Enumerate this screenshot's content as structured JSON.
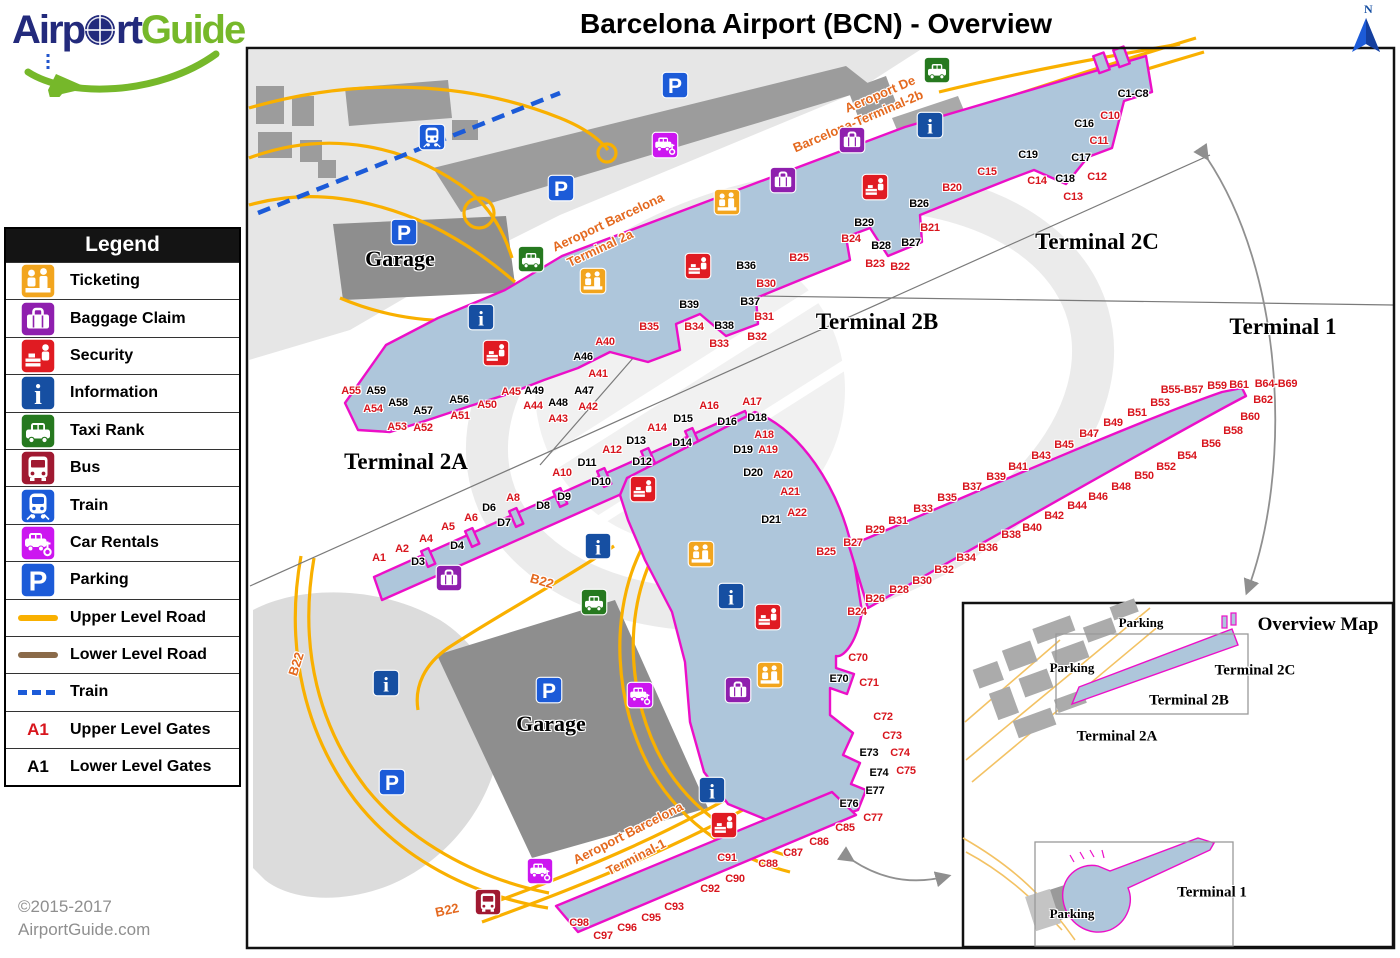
{
  "header": {
    "logo": {
      "airport_part1": "Airp",
      "airport_part2": "rt",
      "guide": "Guide"
    },
    "title": "Barcelona Airport (BCN) - Overview",
    "compass_label": "N"
  },
  "footer": {
    "copyright_line1": "©2015-2017",
    "copyright_line2": "AirportGuide.com"
  },
  "colors": {
    "terminal_fill": "#aec6db",
    "terminal_outline": "#ec0fc8",
    "road_upper": "#f9b000",
    "road_lower": "#8a6a49",
    "train_line": "#1c5bd8",
    "gate_upper": "#d8151d",
    "gate_lower": "#000000",
    "ticketing": "#f2a51e",
    "baggage": "#8f1fae",
    "security": "#e01b22",
    "information": "#164fa2",
    "taxi": "#26791f",
    "bus": "#a01931",
    "train": "#1c5bd8",
    "car_rental": "#cc16f0",
    "parking": "#1c5bd8"
  },
  "legend": {
    "title": "Legend",
    "items": [
      {
        "kind": "icon",
        "icon": "ticketing",
        "label": "Ticketing"
      },
      {
        "kind": "icon",
        "icon": "baggage",
        "label": "Baggage Claim"
      },
      {
        "kind": "icon",
        "icon": "security",
        "label": "Security"
      },
      {
        "kind": "icon",
        "icon": "information",
        "label": "Information"
      },
      {
        "kind": "icon",
        "icon": "taxi",
        "label": "Taxi Rank"
      },
      {
        "kind": "icon",
        "icon": "bus",
        "label": "Bus"
      },
      {
        "kind": "icon",
        "icon": "train",
        "label": "Train"
      },
      {
        "kind": "icon",
        "icon": "car-rental",
        "label": "Car Rentals"
      },
      {
        "kind": "icon",
        "icon": "parking",
        "label": "Parking"
      },
      {
        "kind": "line",
        "line": "upper-road",
        "label": "Upper Level Road"
      },
      {
        "kind": "line",
        "line": "lower-road",
        "label": "Lower Level  Road"
      },
      {
        "kind": "line",
        "line": "train-line",
        "label": "Train"
      },
      {
        "kind": "gate",
        "sample": "A1",
        "level": "upper",
        "label": "Upper Level Gates"
      },
      {
        "kind": "gate",
        "sample": "A1",
        "level": "lower",
        "label": "Lower Level Gates"
      }
    ]
  },
  "map": {
    "terminal_labels": [
      {
        "text": "Terminal 2C",
        "x": 1097,
        "y": 242
      },
      {
        "text": "Terminal 2B",
        "x": 877,
        "y": 322
      },
      {
        "text": "Terminal 1",
        "x": 1283,
        "y": 327
      },
      {
        "text": "Terminal 2A",
        "x": 406,
        "y": 462
      }
    ],
    "garage_labels": [
      {
        "text": "Garage",
        "x": 400,
        "y": 259
      },
      {
        "text": "Garage",
        "x": 551,
        "y": 724
      }
    ],
    "road_labels": [
      {
        "text": "Aeroport De",
        "x": 880,
        "y": 94,
        "rotate": -23
      },
      {
        "text": "Barcelona-Terminal-2b",
        "x": 858,
        "y": 121,
        "rotate": -23
      },
      {
        "text": "Aeroport Barcelona",
        "x": 608,
        "y": 222,
        "rotate": -25
      },
      {
        "text": "Terminal 2a",
        "x": 600,
        "y": 248,
        "rotate": -25
      },
      {
        "text": "Aeroport Barcelona",
        "x": 628,
        "y": 833,
        "rotate": -27
      },
      {
        "text": "Terminal-1",
        "x": 636,
        "y": 857,
        "rotate": -27
      },
      {
        "text": "B22",
        "x": 542,
        "y": 581,
        "rotate": 16
      },
      {
        "text": "B22",
        "x": 296,
        "y": 664,
        "rotate": -72
      },
      {
        "text": "B22",
        "x": 447,
        "y": 910,
        "rotate": -12
      }
    ],
    "gates_upper": [
      {
        "text": "C10",
        "x": 1110,
        "y": 116
      },
      {
        "text": "C11",
        "x": 1099,
        "y": 141
      },
      {
        "text": "C12",
        "x": 1097,
        "y": 177
      },
      {
        "text": "C13",
        "x": 1073,
        "y": 197
      },
      {
        "text": "C14",
        "x": 1037,
        "y": 181
      },
      {
        "text": "C15",
        "x": 987,
        "y": 172
      },
      {
        "text": "B20",
        "x": 952,
        "y": 188
      },
      {
        "text": "B21",
        "x": 930,
        "y": 228
      },
      {
        "text": "B22",
        "x": 900,
        "y": 267
      },
      {
        "text": "B23",
        "x": 875,
        "y": 264
      },
      {
        "text": "B24",
        "x": 851,
        "y": 239
      },
      {
        "text": "B25",
        "x": 799,
        "y": 258
      },
      {
        "text": "B30",
        "x": 766,
        "y": 284
      },
      {
        "text": "B31",
        "x": 764,
        "y": 317
      },
      {
        "text": "B32",
        "x": 757,
        "y": 337
      },
      {
        "text": "B33",
        "x": 719,
        "y": 344
      },
      {
        "text": "B34",
        "x": 694,
        "y": 327
      },
      {
        "text": "B35",
        "x": 649,
        "y": 327
      },
      {
        "text": "A40",
        "x": 605,
        "y": 342
      },
      {
        "text": "A41",
        "x": 598,
        "y": 374
      },
      {
        "text": "A42",
        "x": 588,
        "y": 407
      },
      {
        "text": "A43",
        "x": 558,
        "y": 419
      },
      {
        "text": "A44",
        "x": 533,
        "y": 406
      },
      {
        "text": "A45",
        "x": 511,
        "y": 392
      },
      {
        "text": "A50",
        "x": 487,
        "y": 405
      },
      {
        "text": "A51",
        "x": 460,
        "y": 416
      },
      {
        "text": "A52",
        "x": 423,
        "y": 428
      },
      {
        "text": "A53",
        "x": 397,
        "y": 427
      },
      {
        "text": "A54",
        "x": 373,
        "y": 409
      },
      {
        "text": "A55",
        "x": 351,
        "y": 391
      },
      {
        "text": "A16",
        "x": 709,
        "y": 406
      },
      {
        "text": "A17",
        "x": 752,
        "y": 402
      },
      {
        "text": "A18",
        "x": 764,
        "y": 435
      },
      {
        "text": "A19",
        "x": 768,
        "y": 450
      },
      {
        "text": "A14",
        "x": 657,
        "y": 428
      },
      {
        "text": "A12",
        "x": 612,
        "y": 450
      },
      {
        "text": "A10",
        "x": 562,
        "y": 473
      },
      {
        "text": "A8",
        "x": 513,
        "y": 498
      },
      {
        "text": "A6",
        "x": 471,
        "y": 518
      },
      {
        "text": "A5",
        "x": 448,
        "y": 527
      },
      {
        "text": "A4",
        "x": 426,
        "y": 539
      },
      {
        "text": "A2",
        "x": 402,
        "y": 549
      },
      {
        "text": "A1",
        "x": 379,
        "y": 558
      },
      {
        "text": "A20",
        "x": 783,
        "y": 475
      },
      {
        "text": "A21",
        "x": 790,
        "y": 492
      },
      {
        "text": "A22",
        "x": 797,
        "y": 513
      },
      {
        "text": "B25",
        "x": 826,
        "y": 552
      },
      {
        "text": "B27",
        "x": 853,
        "y": 543
      },
      {
        "text": "B29",
        "x": 875,
        "y": 530
      },
      {
        "text": "B31",
        "x": 898,
        "y": 521
      },
      {
        "text": "B33",
        "x": 923,
        "y": 509
      },
      {
        "text": "B35",
        "x": 947,
        "y": 498
      },
      {
        "text": "B37",
        "x": 972,
        "y": 487
      },
      {
        "text": "B39",
        "x": 996,
        "y": 477
      },
      {
        "text": "B41",
        "x": 1018,
        "y": 467
      },
      {
        "text": "B43",
        "x": 1041,
        "y": 456
      },
      {
        "text": "B45",
        "x": 1064,
        "y": 445
      },
      {
        "text": "B47",
        "x": 1089,
        "y": 434
      },
      {
        "text": "B49",
        "x": 1113,
        "y": 423
      },
      {
        "text": "B51",
        "x": 1137,
        "y": 413
      },
      {
        "text": "B53",
        "x": 1160,
        "y": 403
      },
      {
        "text": "B55-B57",
        "x": 1182,
        "y": 390
      },
      {
        "text": "B59",
        "x": 1217,
        "y": 386
      },
      {
        "text": "B61",
        "x": 1239,
        "y": 385
      },
      {
        "text": "B64-B69",
        "x": 1276,
        "y": 384
      },
      {
        "text": "B62",
        "x": 1263,
        "y": 400
      },
      {
        "text": "B60",
        "x": 1250,
        "y": 417
      },
      {
        "text": "B58",
        "x": 1233,
        "y": 431
      },
      {
        "text": "B56",
        "x": 1211,
        "y": 444
      },
      {
        "text": "B54",
        "x": 1187,
        "y": 456
      },
      {
        "text": "B52",
        "x": 1166,
        "y": 467
      },
      {
        "text": "B50",
        "x": 1144,
        "y": 476
      },
      {
        "text": "B48",
        "x": 1121,
        "y": 487
      },
      {
        "text": "B46",
        "x": 1098,
        "y": 497
      },
      {
        "text": "B44",
        "x": 1077,
        "y": 506
      },
      {
        "text": "B42",
        "x": 1054,
        "y": 516
      },
      {
        "text": "B40",
        "x": 1032,
        "y": 528
      },
      {
        "text": "B38",
        "x": 1011,
        "y": 535
      },
      {
        "text": "B36",
        "x": 988,
        "y": 548
      },
      {
        "text": "B34",
        "x": 966,
        "y": 558
      },
      {
        "text": "B32",
        "x": 944,
        "y": 570
      },
      {
        "text": "B30",
        "x": 922,
        "y": 581
      },
      {
        "text": "B28",
        "x": 899,
        "y": 590
      },
      {
        "text": "B26",
        "x": 875,
        "y": 599
      },
      {
        "text": "B24",
        "x": 857,
        "y": 612
      },
      {
        "text": "C70",
        "x": 858,
        "y": 658
      },
      {
        "text": "C71",
        "x": 869,
        "y": 683
      },
      {
        "text": "C72",
        "x": 883,
        "y": 717
      },
      {
        "text": "C73",
        "x": 892,
        "y": 736
      },
      {
        "text": "C74",
        "x": 900,
        "y": 753
      },
      {
        "text": "C75",
        "x": 906,
        "y": 771
      },
      {
        "text": "C77",
        "x": 873,
        "y": 818
      },
      {
        "text": "C85",
        "x": 845,
        "y": 828
      },
      {
        "text": "C86",
        "x": 819,
        "y": 842
      },
      {
        "text": "C87",
        "x": 793,
        "y": 853
      },
      {
        "text": "C88",
        "x": 768,
        "y": 864
      },
      {
        "text": "C91",
        "x": 727,
        "y": 858
      },
      {
        "text": "C90",
        "x": 735,
        "y": 879
      },
      {
        "text": "C92",
        "x": 710,
        "y": 889
      },
      {
        "text": "C93",
        "x": 674,
        "y": 907
      },
      {
        "text": "C95",
        "x": 651,
        "y": 918
      },
      {
        "text": "C96",
        "x": 627,
        "y": 928
      },
      {
        "text": "C98",
        "x": 579,
        "y": 923
      },
      {
        "text": "C97",
        "x": 603,
        "y": 936
      }
    ],
    "gates_lower": [
      {
        "text": "C1-C8",
        "x": 1133,
        "y": 94
      },
      {
        "text": "C16",
        "x": 1084,
        "y": 124
      },
      {
        "text": "C17",
        "x": 1081,
        "y": 158
      },
      {
        "text": "C18",
        "x": 1065,
        "y": 179
      },
      {
        "text": "C19",
        "x": 1028,
        "y": 155
      },
      {
        "text": "B26",
        "x": 919,
        "y": 204
      },
      {
        "text": "B27",
        "x": 911,
        "y": 243
      },
      {
        "text": "B28",
        "x": 881,
        "y": 246
      },
      {
        "text": "B29",
        "x": 864,
        "y": 223
      },
      {
        "text": "B36",
        "x": 746,
        "y": 266
      },
      {
        "text": "B37",
        "x": 750,
        "y": 302
      },
      {
        "text": "B38",
        "x": 724,
        "y": 326
      },
      {
        "text": "B39",
        "x": 689,
        "y": 305
      },
      {
        "text": "A46",
        "x": 583,
        "y": 357
      },
      {
        "text": "A47",
        "x": 584,
        "y": 391
      },
      {
        "text": "A48",
        "x": 558,
        "y": 403
      },
      {
        "text": "A49",
        "x": 534,
        "y": 391
      },
      {
        "text": "A56",
        "x": 459,
        "y": 400
      },
      {
        "text": "A57",
        "x": 423,
        "y": 411
      },
      {
        "text": "A58",
        "x": 398,
        "y": 403
      },
      {
        "text": "A59",
        "x": 376,
        "y": 391
      },
      {
        "text": "D15",
        "x": 683,
        "y": 419
      },
      {
        "text": "D16",
        "x": 727,
        "y": 422
      },
      {
        "text": "D18",
        "x": 757,
        "y": 418
      },
      {
        "text": "D19",
        "x": 743,
        "y": 450
      },
      {
        "text": "D20",
        "x": 753,
        "y": 473
      },
      {
        "text": "D13",
        "x": 636,
        "y": 441
      },
      {
        "text": "D14",
        "x": 682,
        "y": 443
      },
      {
        "text": "D11",
        "x": 587,
        "y": 463
      },
      {
        "text": "D12",
        "x": 642,
        "y": 462
      },
      {
        "text": "D10",
        "x": 601,
        "y": 482
      },
      {
        "text": "D9",
        "x": 564,
        "y": 497
      },
      {
        "text": "D8",
        "x": 543,
        "y": 506
      },
      {
        "text": "D7",
        "x": 504,
        "y": 523
      },
      {
        "text": "D6",
        "x": 489,
        "y": 508
      },
      {
        "text": "D4",
        "x": 457,
        "y": 546
      },
      {
        "text": "D3",
        "x": 418,
        "y": 562
      },
      {
        "text": "D21",
        "x": 771,
        "y": 520
      },
      {
        "text": "E70",
        "x": 839,
        "y": 679
      },
      {
        "text": "E73",
        "x": 869,
        "y": 753
      },
      {
        "text": "E74",
        "x": 879,
        "y": 773
      },
      {
        "text": "E76",
        "x": 849,
        "y": 804
      },
      {
        "text": "E77",
        "x": 875,
        "y": 791
      }
    ],
    "icons": [
      {
        "type": "train",
        "x": 432,
        "y": 137
      },
      {
        "type": "parking",
        "x": 675,
        "y": 85
      },
      {
        "type": "parking",
        "x": 561,
        "y": 188
      },
      {
        "type": "parking",
        "x": 404,
        "y": 232
      },
      {
        "type": "taxi",
        "x": 531,
        "y": 259
      },
      {
        "type": "car-rental",
        "x": 665,
        "y": 145
      },
      {
        "type": "taxi",
        "x": 937,
        "y": 70
      },
      {
        "type": "information",
        "x": 930,
        "y": 125
      },
      {
        "type": "baggage",
        "x": 852,
        "y": 140
      },
      {
        "type": "security",
        "x": 875,
        "y": 187
      },
      {
        "type": "baggage",
        "x": 783,
        "y": 180
      },
      {
        "type": "ticketing",
        "x": 727,
        "y": 202
      },
      {
        "type": "security",
        "x": 698,
        "y": 266
      },
      {
        "type": "ticketing",
        "x": 593,
        "y": 281
      },
      {
        "type": "information",
        "x": 481,
        "y": 317
      },
      {
        "type": "security",
        "x": 496,
        "y": 353
      },
      {
        "type": "security",
        "x": 643,
        "y": 489
      },
      {
        "type": "information",
        "x": 598,
        "y": 546
      },
      {
        "type": "baggage",
        "x": 449,
        "y": 578
      },
      {
        "type": "taxi",
        "x": 594,
        "y": 602
      },
      {
        "type": "ticketing",
        "x": 701,
        "y": 554
      },
      {
        "type": "information",
        "x": 731,
        "y": 596
      },
      {
        "type": "security",
        "x": 768,
        "y": 617
      },
      {
        "type": "information",
        "x": 386,
        "y": 683
      },
      {
        "type": "car-rental",
        "x": 640,
        "y": 695
      },
      {
        "type": "parking",
        "x": 549,
        "y": 690
      },
      {
        "type": "baggage",
        "x": 738,
        "y": 690
      },
      {
        "type": "ticketing",
        "x": 770,
        "y": 675
      },
      {
        "type": "information",
        "x": 712,
        "y": 790
      },
      {
        "type": "security",
        "x": 724,
        "y": 825
      },
      {
        "type": "car-rental",
        "x": 540,
        "y": 871
      },
      {
        "type": "bus",
        "x": 488,
        "y": 902
      },
      {
        "type": "parking",
        "x": 392,
        "y": 782
      }
    ],
    "inset": {
      "title": "Overview Map",
      "title_pos": {
        "x": 1318,
        "y": 625
      },
      "terminal_labels": [
        {
          "text": "Terminal 2C",
          "x": 1255,
          "y": 671
        },
        {
          "text": "Terminal 2B",
          "x": 1189,
          "y": 701
        },
        {
          "text": "Terminal 2A",
          "x": 1117,
          "y": 737
        },
        {
          "text": "Terminal 1",
          "x": 1212,
          "y": 893
        }
      ],
      "parking_labels": [
        {
          "text": "Parking",
          "x": 1141,
          "y": 623
        },
        {
          "text": "Parking",
          "x": 1072,
          "y": 668
        },
        {
          "text": "Parking",
          "x": 1072,
          "y": 914
        }
      ]
    }
  }
}
